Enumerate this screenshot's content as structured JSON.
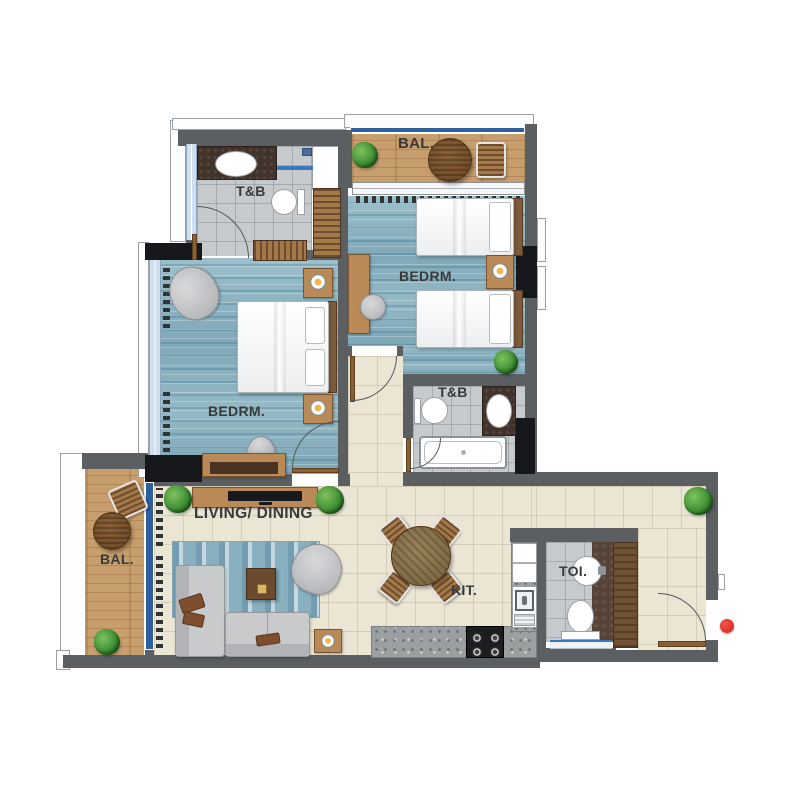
{
  "floor_plan": {
    "rooms": {
      "balcony_top": "BAL.",
      "bathroom_top": "T&B",
      "bedroom_right": "BEDRM.",
      "bedroom_left": "BEDRM.",
      "bathroom_middle": "T&B",
      "living_dining": "LIVING/ DINING",
      "balcony_left": "BAL.",
      "kitchen": "KIT.",
      "toilet": "TOI."
    },
    "colors": {
      "wall": "#5b5f62",
      "structure_black": "#16181b",
      "bedroom_floor": "#8fb5c3",
      "tile_floor": "#ebe5d4",
      "bathroom_tile": "#c6cacd",
      "balcony_wood": "#c79e6d",
      "counter_speckle": "#9aa0a0",
      "door_wood": "#8a5f34",
      "window_glass": "#cfdfed",
      "railing_blue": "#2e5f9e",
      "plant_green": "#3f8f35",
      "label_text": "#37393b",
      "entry_marker": "#e53229"
    },
    "marker": {
      "type": "entry-door-dot",
      "color": "#e53229"
    }
  }
}
